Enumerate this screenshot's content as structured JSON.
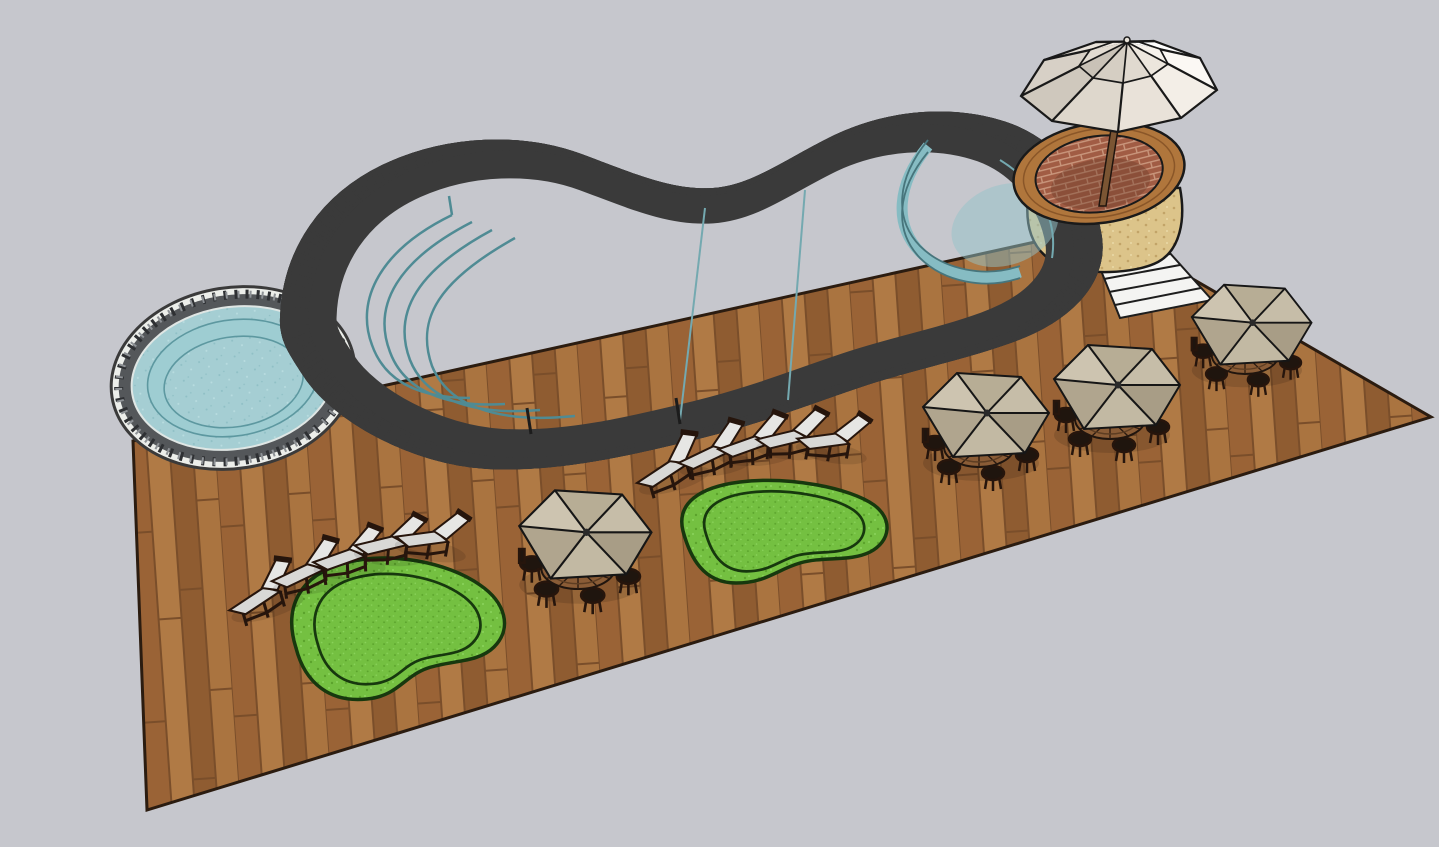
{
  "scene": {
    "description": "3D architectural render of a resort pool deck viewed from above at an angle",
    "objects": [
      {
        "name": "main-pool",
        "type": "freeform swimming pool",
        "features": [
          "curved cascading steps",
          "shallow ledge lines",
          "raised s-curve wall at deep end",
          "dark stone coping with white trim"
        ],
        "count": 1
      },
      {
        "name": "spa-pool",
        "type": "round spa pool with bench ring",
        "count": 1
      },
      {
        "name": "wood-deck",
        "type": "hardwood plank deck platform",
        "count": 1
      },
      {
        "name": "grass-patch",
        "type": "kidney-shaped lawn inset with border",
        "count": 2
      },
      {
        "name": "lounge-chair",
        "type": "dark wood chaise lounge with white cushion",
        "count": 10
      },
      {
        "name": "umbrella-table-set",
        "type": "round slatted table with tan patio umbrella and chairs",
        "count": 4
      },
      {
        "name": "hot-tub",
        "type": "raised circular brick hot tub with wood rim and stone base",
        "count": 1
      },
      {
        "name": "large-white-umbrella",
        "type": "two-tier white market umbrella over hot tub",
        "count": 1
      },
      {
        "name": "stairs",
        "type": "white steps beside hot tub leading off deck",
        "count": 1
      }
    ]
  },
  "colors": {
    "background": "#c6c7cd",
    "deck_base": "#a9713f",
    "deck_outline": "#2b1c10",
    "water": "#a5ced3",
    "water_shelf": "#9ecdd2",
    "pool_inner_line": "#5d98a0",
    "step_line": "#4f8b94",
    "swall": "#86bcc3",
    "coping": "#54575a",
    "coping_trim": "#eceeea",
    "outline": "#1d1d1d",
    "grass": "#74c041",
    "grass_border": "#17380e",
    "cushion": "#d8d8d6",
    "cushion_back": "#e6e6e4",
    "chair_frame": "#26150c",
    "table_wood": "#8a5c36",
    "pole_wood": "#7b5533",
    "brick": "#a15c44",
    "brick_mortar": "#c9967c",
    "stone_base": "#dcc48a",
    "wood_rim": "#b0763c",
    "stairs_fill": "#f4f4f2",
    "tan_umbrella_panels": [
      "#cdc4b0",
      "#b7ad95",
      "#c6bda8",
      "#a89d86",
      "#c2b9a3",
      "#b0a58e"
    ],
    "big_umbrella_panels": [
      "#d7d0c6",
      "#e9e3da",
      "#f6f2ec",
      "#ffffff",
      "#fbf8f4",
      "#f3eee7",
      "#e9e2d9",
      "#ded7cc",
      "#cfc8bd"
    ],
    "big_umbrella_top_panels": [
      "#e2dbd1",
      "#efe9e1",
      "#f8f5f0",
      "#ffffff",
      "#f6f2ec",
      "#ece6dd",
      "#e0d9cf",
      "#d5cec3",
      "#c9c2b7"
    ]
  }
}
